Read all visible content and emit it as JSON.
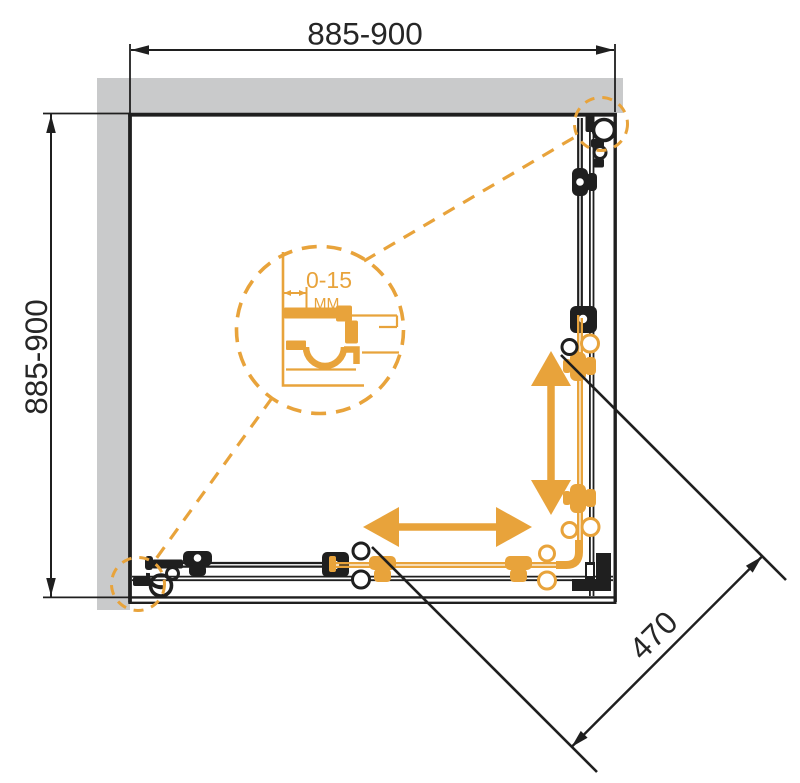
{
  "dimensions": {
    "width": {
      "value": "885-900"
    },
    "depth": {
      "value": "885-900"
    },
    "entry_diagonal": {
      "value": "470"
    },
    "wall_profile_adjustment": {
      "value": "0-15",
      "unit": "MM"
    }
  },
  "colors": {
    "accent_orange": "#E8A33B",
    "wall_gray": "#C9CACB",
    "line_black": "#1F1F1F"
  },
  "icons": {
    "slide_horizontal": "double-arrow-horizontal",
    "slide_vertical": "double-arrow-vertical",
    "detail_callout": "dashed-circle-magnifier"
  }
}
